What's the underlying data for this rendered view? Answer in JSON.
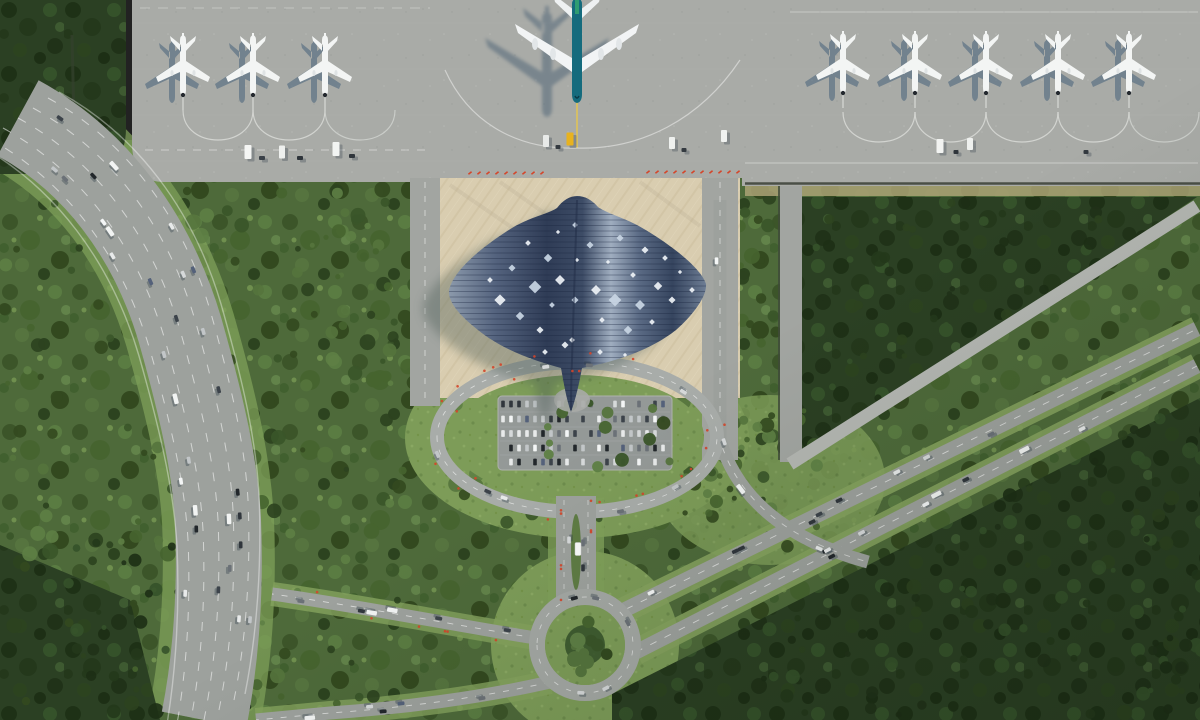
{
  "scene": {
    "type": "aerial-architectural-render",
    "subject": "Tropical airport masterplan: manta-ray-shaped terminal roof on a sand plaza, apron with nine aircraft, oval landside garden with parking, roundabout, curving multi-lane highway and diagonal parkway through dense forest",
    "palette": {
      "apron": "#a9aba7",
      "plaza_sand": "#d9cdb0",
      "roof_dark": "#2f3c56",
      "roof_light": "#9fadbf",
      "forest_mid": "#4e6a3a",
      "forest_dark": "#2b4023",
      "grass": "#7d9c58",
      "road": "#9da19d",
      "marker_red": "#d4452a",
      "big_plane_teal": "#156b7d",
      "fin_green": "#2f9c72",
      "service_yellow": "#e8b21e"
    },
    "apron": {
      "left_plane_xs": [
        183,
        253,
        325
      ],
      "right_plane_xs": [
        843,
        915,
        986,
        1058,
        1129
      ],
      "big_plane": {
        "x": 577,
        "fuselage": "#156b7d",
        "fin": "#2f9c72",
        "accent": "#e8c84a"
      },
      "vehicles": [
        {
          "x": 248,
          "y": 152,
          "c": "#f5f6f4",
          "w": 7,
          "h": 14
        },
        {
          "x": 262,
          "y": 158,
          "c": "#3a4148",
          "w": 6,
          "h": 4
        },
        {
          "x": 282,
          "y": 152,
          "c": "#eef0ee",
          "w": 6,
          "h": 13
        },
        {
          "x": 300,
          "y": 158,
          "c": "#2e343a",
          "w": 6,
          "h": 4
        },
        {
          "x": 336,
          "y": 149,
          "c": "#f2f4f2",
          "w": 7,
          "h": 14
        },
        {
          "x": 352,
          "y": 156,
          "c": "#30363c",
          "w": 6,
          "h": 4
        },
        {
          "x": 546,
          "y": 141,
          "c": "#e8eae8",
          "w": 6,
          "h": 12
        },
        {
          "x": 558,
          "y": 147,
          "c": "#343a40",
          "w": 5,
          "h": 4
        },
        {
          "x": 570,
          "y": 139,
          "c": "#e8b21e",
          "w": 7,
          "h": 13
        },
        {
          "x": 672,
          "y": 143,
          "c": "#eef0ee",
          "w": 6,
          "h": 12
        },
        {
          "x": 684,
          "y": 150,
          "c": "#343a40",
          "w": 5,
          "h": 4
        },
        {
          "x": 724,
          "y": 136,
          "c": "#f0f2f0",
          "w": 6,
          "h": 12
        },
        {
          "x": 940,
          "y": 146,
          "c": "#f2f3f1",
          "w": 7,
          "h": 14
        },
        {
          "x": 956,
          "y": 152,
          "c": "#2f353b",
          "w": 5,
          "h": 4
        },
        {
          "x": 970,
          "y": 144,
          "c": "#eef0ee",
          "w": 6,
          "h": 12
        },
        {
          "x": 1086,
          "y": 152,
          "c": "#33393f",
          "w": 5,
          "h": 4
        }
      ]
    },
    "terminal": {
      "skylights": [
        [
          500,
          300,
          8
        ],
        [
          512,
          268,
          5
        ],
        [
          520,
          316,
          6
        ],
        [
          528,
          243,
          4
        ],
        [
          535,
          287,
          9
        ],
        [
          540,
          330,
          5
        ],
        [
          548,
          258,
          6
        ],
        [
          552,
          305,
          4
        ],
        [
          558,
          232,
          3
        ],
        [
          560,
          280,
          7
        ],
        [
          565,
          345,
          5
        ],
        [
          545,
          352,
          4
        ],
        [
          530,
          360,
          3
        ],
        [
          575,
          225,
          4
        ],
        [
          577,
          260,
          3
        ],
        [
          575,
          300,
          5
        ],
        [
          572,
          340,
          4
        ],
        [
          590,
          245,
          5
        ],
        [
          596,
          290,
          7
        ],
        [
          602,
          320,
          4
        ],
        [
          608,
          262,
          3
        ],
        [
          615,
          300,
          9
        ],
        [
          620,
          238,
          5
        ],
        [
          628,
          330,
          6
        ],
        [
          633,
          275,
          4
        ],
        [
          640,
          305,
          7
        ],
        [
          645,
          250,
          5
        ],
        [
          652,
          322,
          4
        ],
        [
          658,
          286,
          6
        ],
        [
          665,
          258,
          4
        ],
        [
          672,
          300,
          5
        ],
        [
          680,
          272,
          3
        ],
        [
          600,
          352,
          4
        ],
        [
          625,
          355,
          3
        ],
        [
          490,
          280,
          4
        ],
        [
          692,
          290,
          4
        ]
      ]
    },
    "parking": {
      "rows": 5,
      "cols": 21,
      "occupancy": 0.72
    },
    "traffic": {
      "highway": 30,
      "diagonal_upper": 9,
      "diagonal_lower": 9,
      "oval_ring": 8,
      "connector": 3,
      "west_road": 6,
      "sw_road": 5,
      "access_road": 4,
      "roundabout": 5,
      "bus": {
        "x": 578,
        "y": 549
      }
    },
    "markers": {
      "plaza_top": [
        {
          "x0": 470,
          "x1": 546,
          "y": 173,
          "step": 9
        },
        {
          "x0": 648,
          "x1": 746,
          "y": 172,
          "step": 9
        }
      ],
      "flowers": {
        "oval": 24,
        "connector": 8,
        "west": 6
      }
    }
  }
}
